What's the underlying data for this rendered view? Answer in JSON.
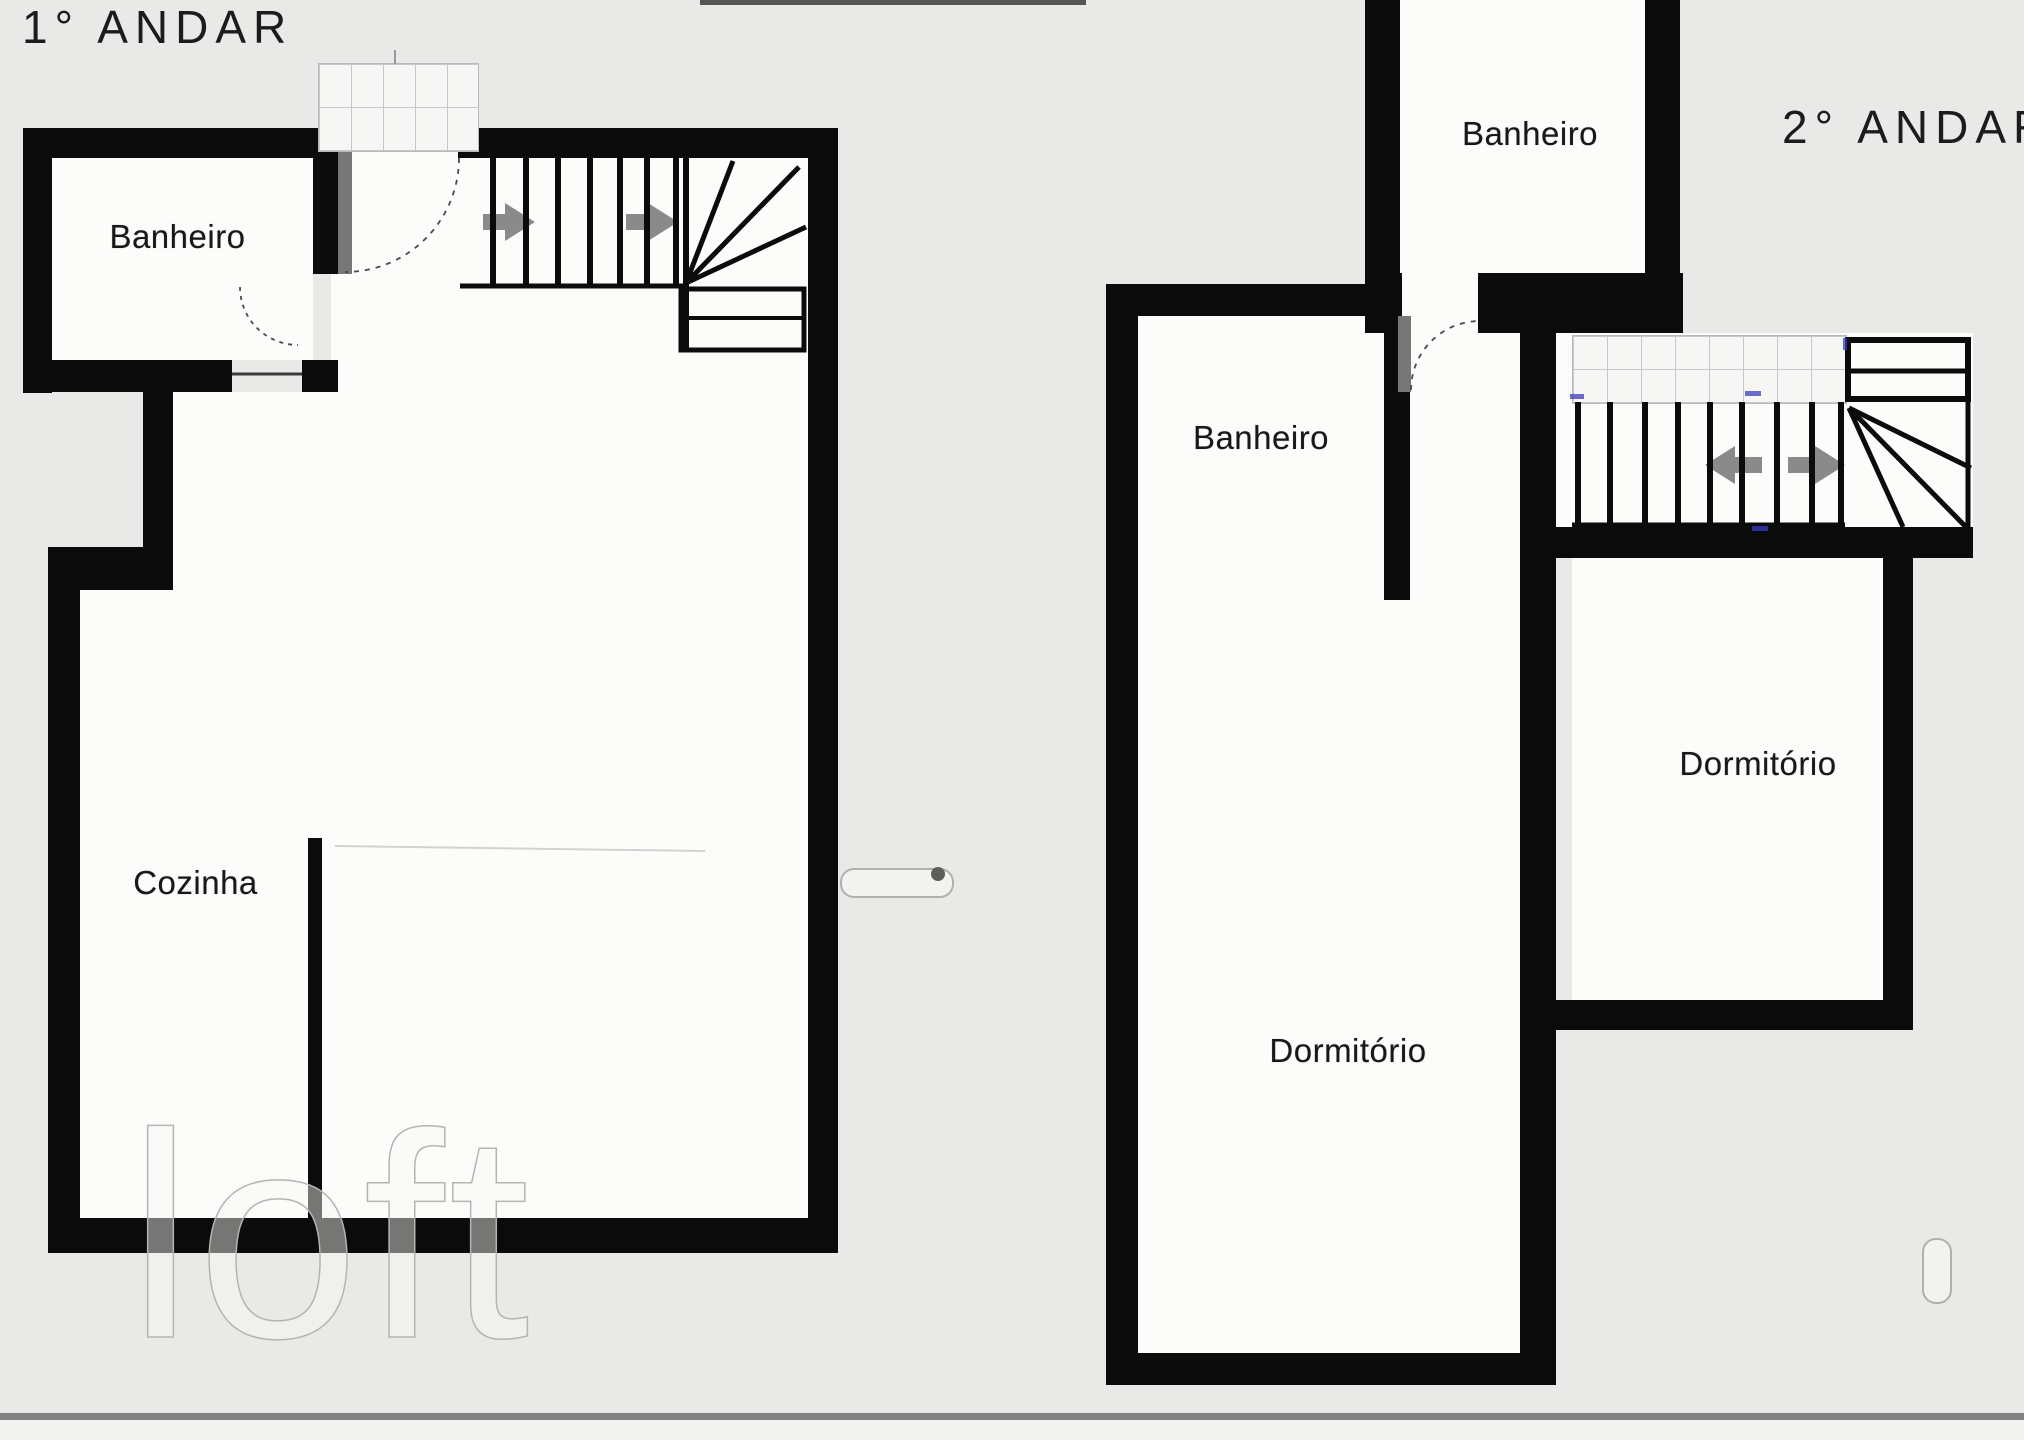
{
  "titles": {
    "floor1": "1° ANDAR",
    "floor2": "2° ANDAR"
  },
  "floor1": {
    "banheiro": "Banheiro",
    "cozinha": "Cozinha"
  },
  "floor2": {
    "banheiro_top": "Banheiro",
    "banheiro": "Banheiro",
    "dormitorio_main": "Dormitório",
    "dormitorio_right": "Dormitório"
  },
  "watermark": "loft",
  "colors": {
    "bg": "#e9e9e7",
    "wall": "#0b0b0b",
    "room": "#fcfcfb",
    "arrow": "#8a8a8a",
    "door": "#777775",
    "wline": "#c8c8cb",
    "tick": "#3c3cc0",
    "divider": "#818181",
    "footer": "#f2f2f0"
  }
}
